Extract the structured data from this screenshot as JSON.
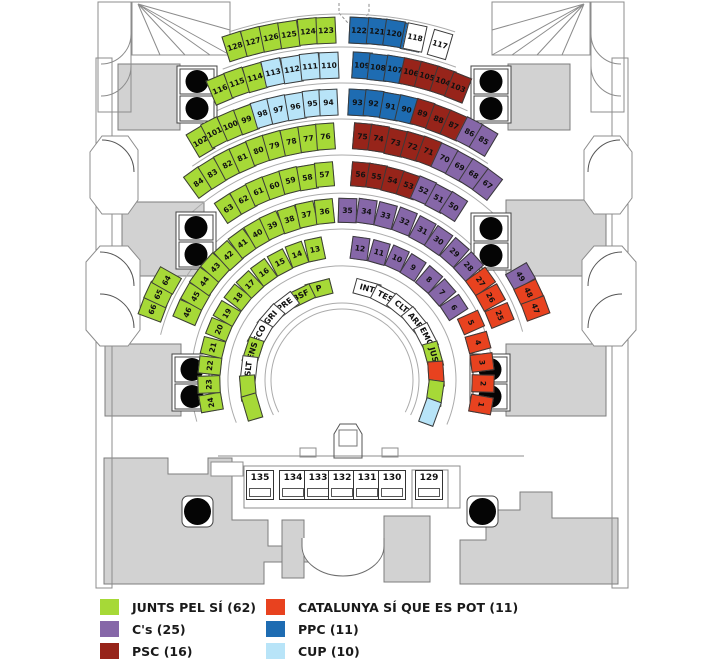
{
  "title": "parliament-seating-plan",
  "legend": {
    "items": [
      {
        "label": "JUNTS PEL SÍ (62)",
        "party": "jxsi",
        "color": "#A6D937"
      },
      {
        "label": "C's (25)",
        "party": "cs",
        "color": "#8667A8"
      },
      {
        "label": "PSC (16)",
        "party": "psc",
        "color": "#97241A"
      },
      {
        "label": "CATALUNYA SÍ QUE ES POT (11)",
        "party": "csqep",
        "color": "#E8421F"
      },
      {
        "label": "PPC (11)",
        "party": "ppc",
        "color": "#1E6CB2"
      },
      {
        "label": "CUP (10)",
        "party": "cup",
        "color": "#B8E4F8"
      }
    ],
    "unassigned_color": "#FFFFFF"
  },
  "desks": [
    "135",
    "134",
    "133",
    "132",
    "131",
    "130",
    "129"
  ],
  "rows": [
    {
      "name": "row-1",
      "blocks": [
        {
          "seats": [
            {
              "n": "128",
              "p": "jxsi"
            },
            {
              "n": "127",
              "p": "jxsi"
            },
            {
              "n": "126",
              "p": "jxsi"
            },
            {
              "n": "125",
              "p": "jxsi"
            },
            {
              "n": "124",
              "p": "jxsi"
            },
            {
              "n": "123",
              "p": "jxsi"
            }
          ]
        },
        {
          "seats": [
            {
              "n": "122",
              "p": "ppc"
            },
            {
              "n": "121",
              "p": "ppc"
            },
            {
              "n": "120",
              "p": "ppc"
            },
            {
              "n": "119",
              "p": "ppc"
            }
          ]
        },
        {
          "seats": [
            {
              "n": "118",
              "p": "none"
            },
            {
              "n": "117",
              "p": "none"
            }
          ]
        }
      ]
    },
    {
      "name": "row-2",
      "blocks": [
        {
          "seats": [
            {
              "n": "116",
              "p": "jxsi"
            },
            {
              "n": "115",
              "p": "jxsi"
            },
            {
              "n": "114",
              "p": "jxsi"
            }
          ]
        },
        {
          "seats": [
            {
              "n": "113",
              "p": "cup"
            },
            {
              "n": "112",
              "p": "cup"
            },
            {
              "n": "111",
              "p": "cup"
            },
            {
              "n": "110",
              "p": "cup"
            }
          ]
        },
        {
          "seats": [
            {
              "n": "109",
              "p": "ppc"
            },
            {
              "n": "108",
              "p": "ppc"
            },
            {
              "n": "107",
              "p": "ppc"
            }
          ]
        },
        {
          "seats": [
            {
              "n": "106",
              "p": "psc"
            },
            {
              "n": "105",
              "p": "psc"
            },
            {
              "n": "104",
              "p": "psc"
            },
            {
              "n": "103",
              "p": "psc"
            }
          ]
        }
      ]
    },
    {
      "name": "row-3",
      "blocks": [
        {
          "seats": [
            {
              "n": "102",
              "p": "jxsi"
            },
            {
              "n": "101",
              "p": "jxsi"
            },
            {
              "n": "100",
              "p": "jxsi"
            },
            {
              "n": "99",
              "p": "jxsi"
            },
            {
              "n": "98",
              "p": "cup"
            },
            {
              "n": "97",
              "p": "cup"
            },
            {
              "n": "96",
              "p": "cup"
            },
            {
              "n": "95",
              "p": "cup"
            },
            {
              "n": "94",
              "p": "cup"
            }
          ]
        },
        {
          "seats": [
            {
              "n": "93",
              "p": "ppc"
            },
            {
              "n": "92",
              "p": "ppc"
            },
            {
              "n": "91",
              "p": "ppc"
            },
            {
              "n": "90",
              "p": "ppc"
            },
            {
              "n": "89",
              "p": "psc"
            },
            {
              "n": "88",
              "p": "psc"
            },
            {
              "n": "87",
              "p": "psc"
            },
            {
              "n": "86",
              "p": "cs"
            },
            {
              "n": "85",
              "p": "cs"
            }
          ]
        }
      ]
    },
    {
      "name": "row-4",
      "blocks": [
        {
          "seats": [
            {
              "n": "84",
              "p": "jxsi"
            },
            {
              "n": "83",
              "p": "jxsi"
            },
            {
              "n": "82",
              "p": "jxsi"
            },
            {
              "n": "81",
              "p": "jxsi"
            },
            {
              "n": "80",
              "p": "jxsi"
            },
            {
              "n": "79",
              "p": "jxsi"
            },
            {
              "n": "78",
              "p": "jxsi"
            },
            {
              "n": "77",
              "p": "jxsi"
            },
            {
              "n": "76",
              "p": "jxsi"
            }
          ]
        },
        {
          "seats": [
            {
              "n": "75",
              "p": "psc"
            },
            {
              "n": "74",
              "p": "psc"
            },
            {
              "n": "73",
              "p": "psc"
            },
            {
              "n": "72",
              "p": "psc"
            },
            {
              "n": "71",
              "p": "psc"
            },
            {
              "n": "70",
              "p": "cs"
            },
            {
              "n": "69",
              "p": "cs"
            },
            {
              "n": "68",
              "p": "cs"
            },
            {
              "n": "67",
              "p": "cs"
            }
          ]
        }
      ]
    },
    {
      "name": "row-5",
      "blocks": [
        {
          "seats": [
            {
              "n": "66",
              "p": "jxsi"
            },
            {
              "n": "65",
              "p": "jxsi"
            },
            {
              "n": "64",
              "p": "jxsi"
            }
          ]
        },
        {
          "seats": [
            {
              "n": "63",
              "p": "jxsi"
            },
            {
              "n": "62",
              "p": "jxsi"
            },
            {
              "n": "61",
              "p": "jxsi"
            },
            {
              "n": "60",
              "p": "jxsi"
            },
            {
              "n": "59",
              "p": "jxsi"
            },
            {
              "n": "58",
              "p": "jxsi"
            },
            {
              "n": "57",
              "p": "jxsi"
            }
          ]
        },
        {
          "seats": [
            {
              "n": "56",
              "p": "psc"
            },
            {
              "n": "55",
              "p": "psc"
            },
            {
              "n": "54",
              "p": "psc"
            },
            {
              "n": "53",
              "p": "psc"
            },
            {
              "n": "52",
              "p": "cs"
            },
            {
              "n": "51",
              "p": "cs"
            },
            {
              "n": "50",
              "p": "cs"
            }
          ]
        },
        {
          "seats": [
            {
              "n": "49",
              "p": "cs"
            },
            {
              "n": "48",
              "p": "csqep"
            },
            {
              "n": "47",
              "p": "csqep"
            }
          ]
        }
      ]
    },
    {
      "name": "row-6",
      "blocks": [
        {
          "seats": [
            {
              "n": "46",
              "p": "jxsi"
            },
            {
              "n": "45",
              "p": "jxsi"
            },
            {
              "n": "44",
              "p": "jxsi"
            },
            {
              "n": "43",
              "p": "jxsi"
            },
            {
              "n": "42",
              "p": "jxsi"
            },
            {
              "n": "41",
              "p": "jxsi"
            },
            {
              "n": "40",
              "p": "jxsi"
            },
            {
              "n": "39",
              "p": "jxsi"
            },
            {
              "n": "38",
              "p": "jxsi"
            },
            {
              "n": "37",
              "p": "jxsi"
            },
            {
              "n": "36",
              "p": "jxsi"
            }
          ]
        },
        {
          "seats": [
            {
              "n": "35",
              "p": "cs"
            },
            {
              "n": "34",
              "p": "cs"
            },
            {
              "n": "33",
              "p": "cs"
            },
            {
              "n": "32",
              "p": "cs"
            },
            {
              "n": "31",
              "p": "cs"
            },
            {
              "n": "30",
              "p": "cs"
            },
            {
              "n": "29",
              "p": "cs"
            },
            {
              "n": "28",
              "p": "cs"
            },
            {
              "n": "27",
              "p": "csqep"
            },
            {
              "n": "26",
              "p": "csqep"
            },
            {
              "n": "25",
              "p": "csqep"
            }
          ]
        }
      ]
    },
    {
      "name": "row-7",
      "blocks": [
        {
          "seats": [
            {
              "n": "24",
              "p": "jxsi"
            },
            {
              "n": "23",
              "p": "jxsi"
            },
            {
              "n": "22",
              "p": "jxsi"
            },
            {
              "n": "21",
              "p": "jxsi"
            },
            {
              "n": "20",
              "p": "jxsi"
            },
            {
              "n": "19",
              "p": "jxsi"
            },
            {
              "n": "18",
              "p": "jxsi"
            },
            {
              "n": "17",
              "p": "jxsi"
            },
            {
              "n": "16",
              "p": "jxsi"
            },
            {
              "n": "15",
              "p": "jxsi"
            },
            {
              "n": "14",
              "p": "jxsi"
            },
            {
              "n": "13",
              "p": "jxsi"
            }
          ]
        },
        {
          "seats": [
            {
              "n": "12",
              "p": "cs"
            },
            {
              "n": "11",
              "p": "cs"
            },
            {
              "n": "10",
              "p": "cs"
            },
            {
              "n": "9",
              "p": "cs"
            },
            {
              "n": "8",
              "p": "cs"
            },
            {
              "n": "7",
              "p": "cs"
            },
            {
              "n": "6",
              "p": "cs"
            }
          ]
        },
        {
          "seats": [
            {
              "n": "5",
              "p": "csqep"
            },
            {
              "n": "4",
              "p": "csqep"
            },
            {
              "n": "3",
              "p": "csqep"
            },
            {
              "n": "2",
              "p": "csqep"
            },
            {
              "n": "1",
              "p": "csqep"
            }
          ]
        }
      ]
    },
    {
      "name": "government-bench",
      "blocks": [
        {
          "seats": [
            {
              "n": "P",
              "p": "jxsi"
            },
            {
              "n": "BSF",
              "p": "jxsi"
            },
            {
              "n": "PRE",
              "p": "none"
            },
            {
              "n": "GRI",
              "p": "none"
            },
            {
              "n": "ECO",
              "p": "none"
            },
            {
              "n": "ENS",
              "p": "jxsi"
            },
            {
              "n": "SLT",
              "p": "none"
            },
            {
              "n": "",
              "p": "jxsi"
            },
            {
              "n": "",
              "p": "jxsi"
            }
          ]
        },
        {
          "seats": [
            {
              "n": "INT",
              "p": "none"
            },
            {
              "n": "TES",
              "p": "none"
            },
            {
              "n": "CLT",
              "p": "none"
            },
            {
              "n": "ARP",
              "p": "none"
            },
            {
              "n": "EMO",
              "p": "none"
            },
            {
              "n": "JUS",
              "p": "jxsi"
            },
            {
              "n": "",
              "p": "csqep"
            },
            {
              "n": "",
              "p": "jxsi"
            },
            {
              "n": "",
              "p": "cup"
            }
          ]
        }
      ]
    }
  ]
}
